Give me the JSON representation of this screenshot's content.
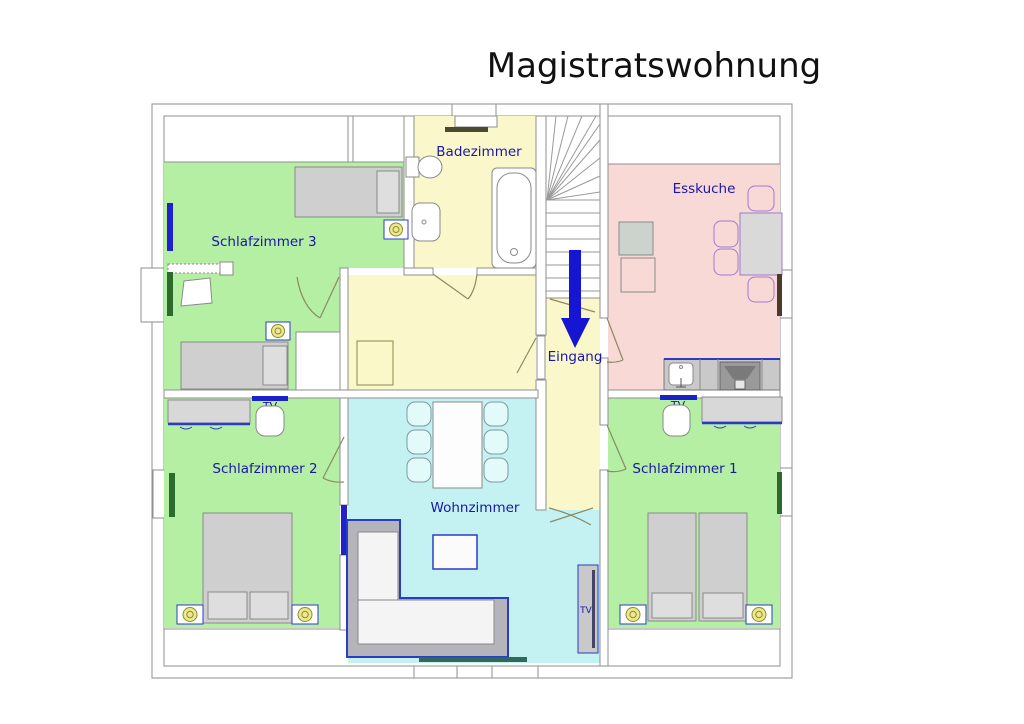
{
  "title": "Magistratswohnung",
  "labels": {
    "schlafzimmer3": "Schlafzimmer 3",
    "badezimmer": "Badezimmer",
    "esskuche": "Esskuche",
    "schlafzimmer2": "Schlafzimmer 2",
    "wohnzimmer": "Wohnzimmer",
    "schlafzimmer1": "Schlafzimmer 1",
    "eingang": "Eingang",
    "tv": "TV"
  },
  "colors": {
    "bedroom_green": "#b5efa3",
    "bath_hall_yellow": "#faf8cb",
    "kitchen_pink": "#f8d9d6",
    "living_cyan": "#c4f2f2",
    "label_blue": "#1a17a8",
    "arrow_blue": "#1616d2",
    "wall_gray": "#8f8f8f",
    "furniture_gray": "#d2d2d2",
    "furniture_blue": "#2b3cc4",
    "window_blue": "#2222cc",
    "window_green": "#2d6a2d",
    "window_teal": "#2d6a5a",
    "tv_blue": "#1b23c8",
    "lamp_yellow": "#ede98a"
  }
}
